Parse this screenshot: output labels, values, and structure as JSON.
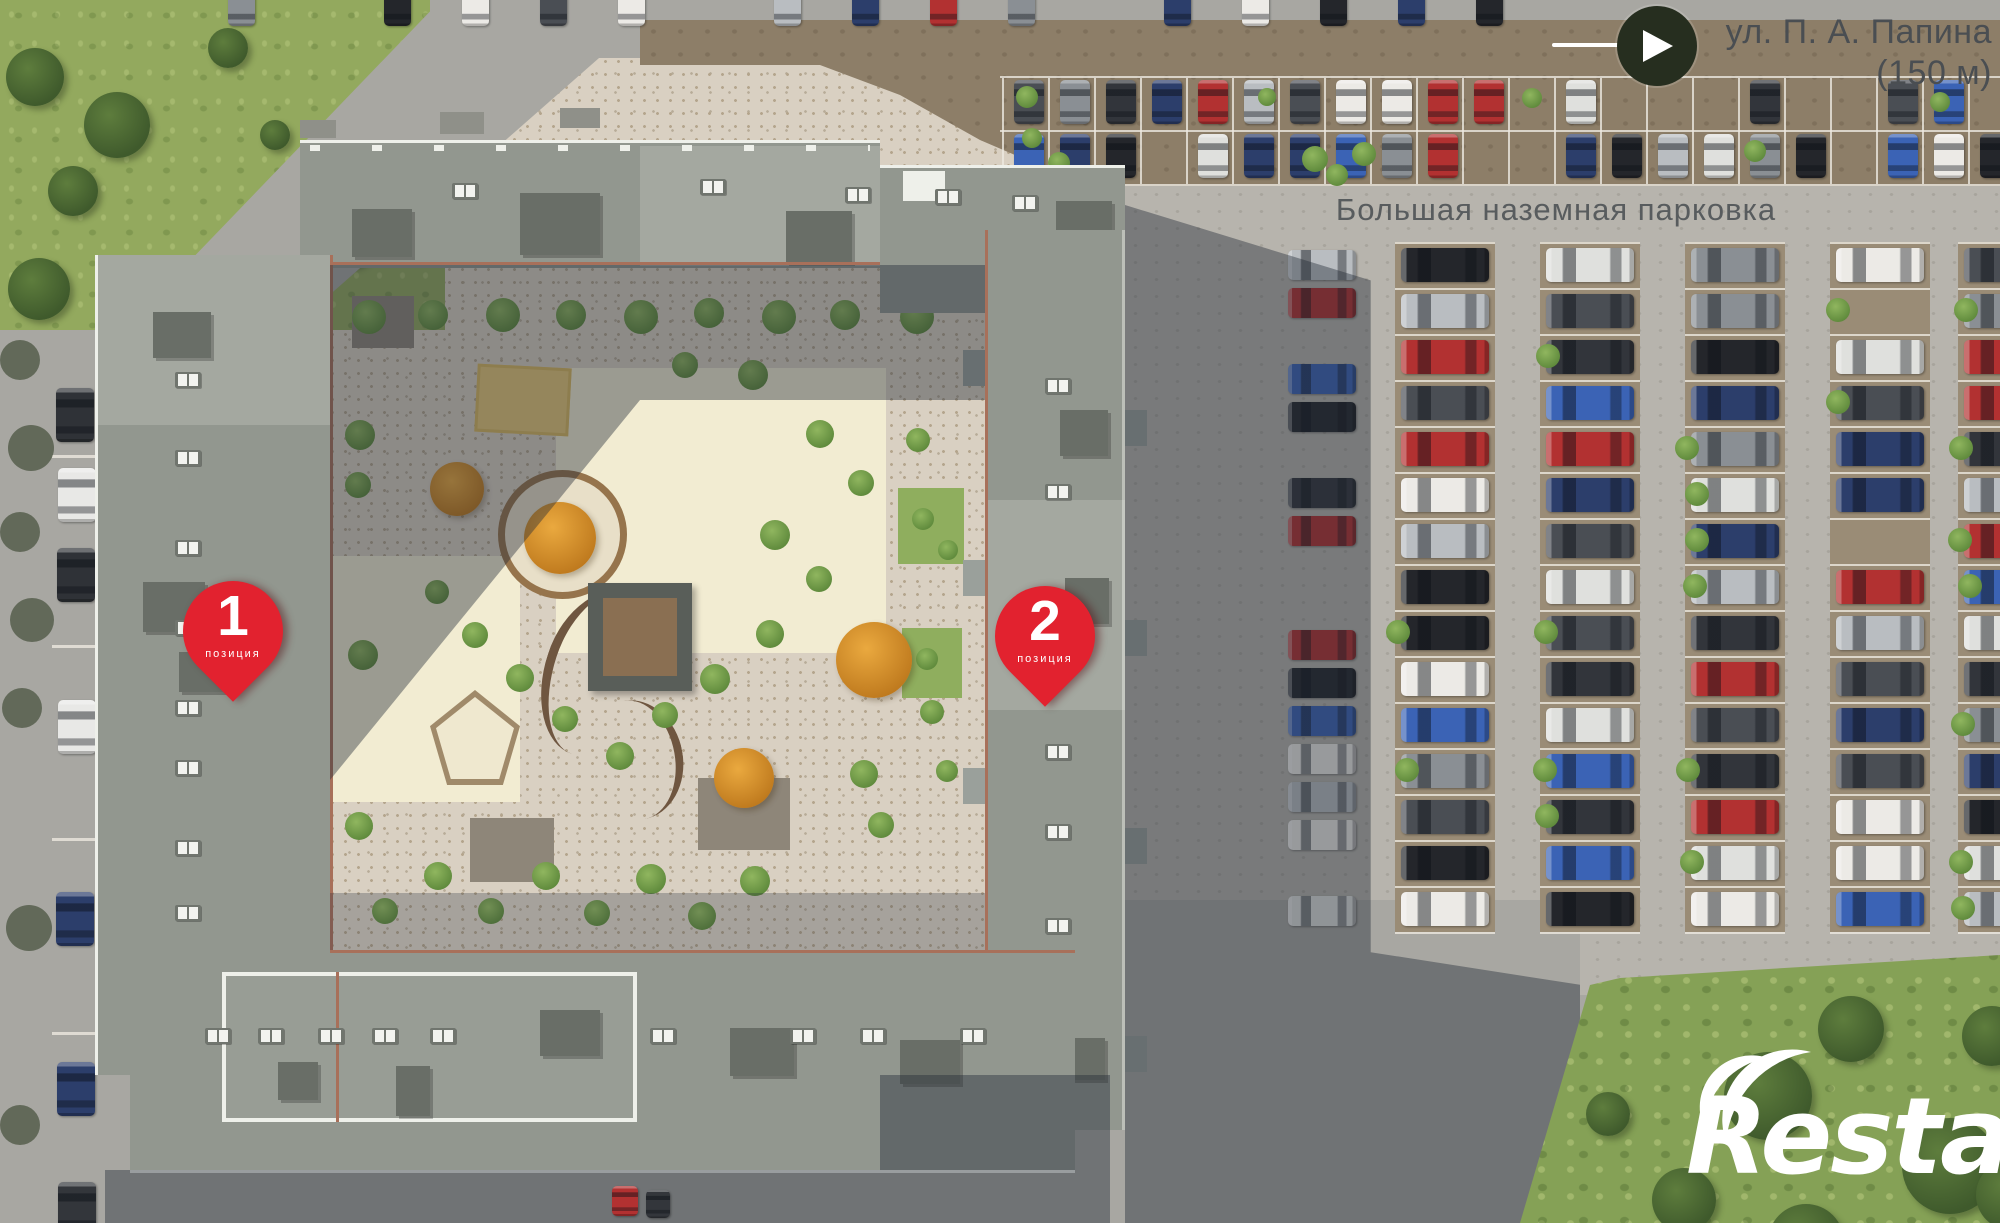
{
  "street_sign": {
    "line1": "ул. П. А. Папина",
    "line2": "(150 м)"
  },
  "parking_area": {
    "label": "Большая наземная парковка"
  },
  "pins": [
    {
      "number": "1",
      "caption": "позиция"
    },
    {
      "number": "2",
      "caption": "позиция"
    }
  ],
  "watermark": {
    "brand": "Restate"
  },
  "colors": {
    "pin_red": "#e2222f",
    "street_text": "#4a4e52",
    "parking_text": "#585c5e",
    "road": "#a8a7a2",
    "aisle": "#b7b4ad",
    "stall": "#9a8c76",
    "band_brown": "#8d7e68",
    "paving": "#d9d0c2",
    "paving_dot": "#b4a58d",
    "grass": "#93a95e",
    "lawn": "#85a156",
    "cream": "#f2ecd2",
    "sand": "#e7c878",
    "roof": "#92978f",
    "roof_light": "#a4a8a0",
    "roof_dark": "#696e67",
    "parapet": "#eef0ea",
    "brick": "#a8705a",
    "gazebo_roof": "#595e59",
    "gazebo_floor": "#8a6f52"
  },
  "parking": {
    "seed": 42,
    "top": 242,
    "stall_height": 46,
    "column_width": 100,
    "occupancy": 0.9,
    "bush_chance": 0.32,
    "columns": [
      {
        "x": 1395,
        "stalls": 15
      },
      {
        "x": 1540,
        "stalls": 15
      },
      {
        "x": 1685,
        "stalls": 15
      },
      {
        "x": 1830,
        "stalls": 15
      },
      {
        "x": 1958,
        "stalls": 15
      }
    ],
    "car_palette": [
      "#32353b",
      "#24262b",
      "#eceae6",
      "#b9bdc1",
      "#8a8f94",
      "#2c3e6b",
      "#b23131",
      "#3b63b5",
      "#4a4e54",
      "#dfe0dd"
    ]
  }
}
